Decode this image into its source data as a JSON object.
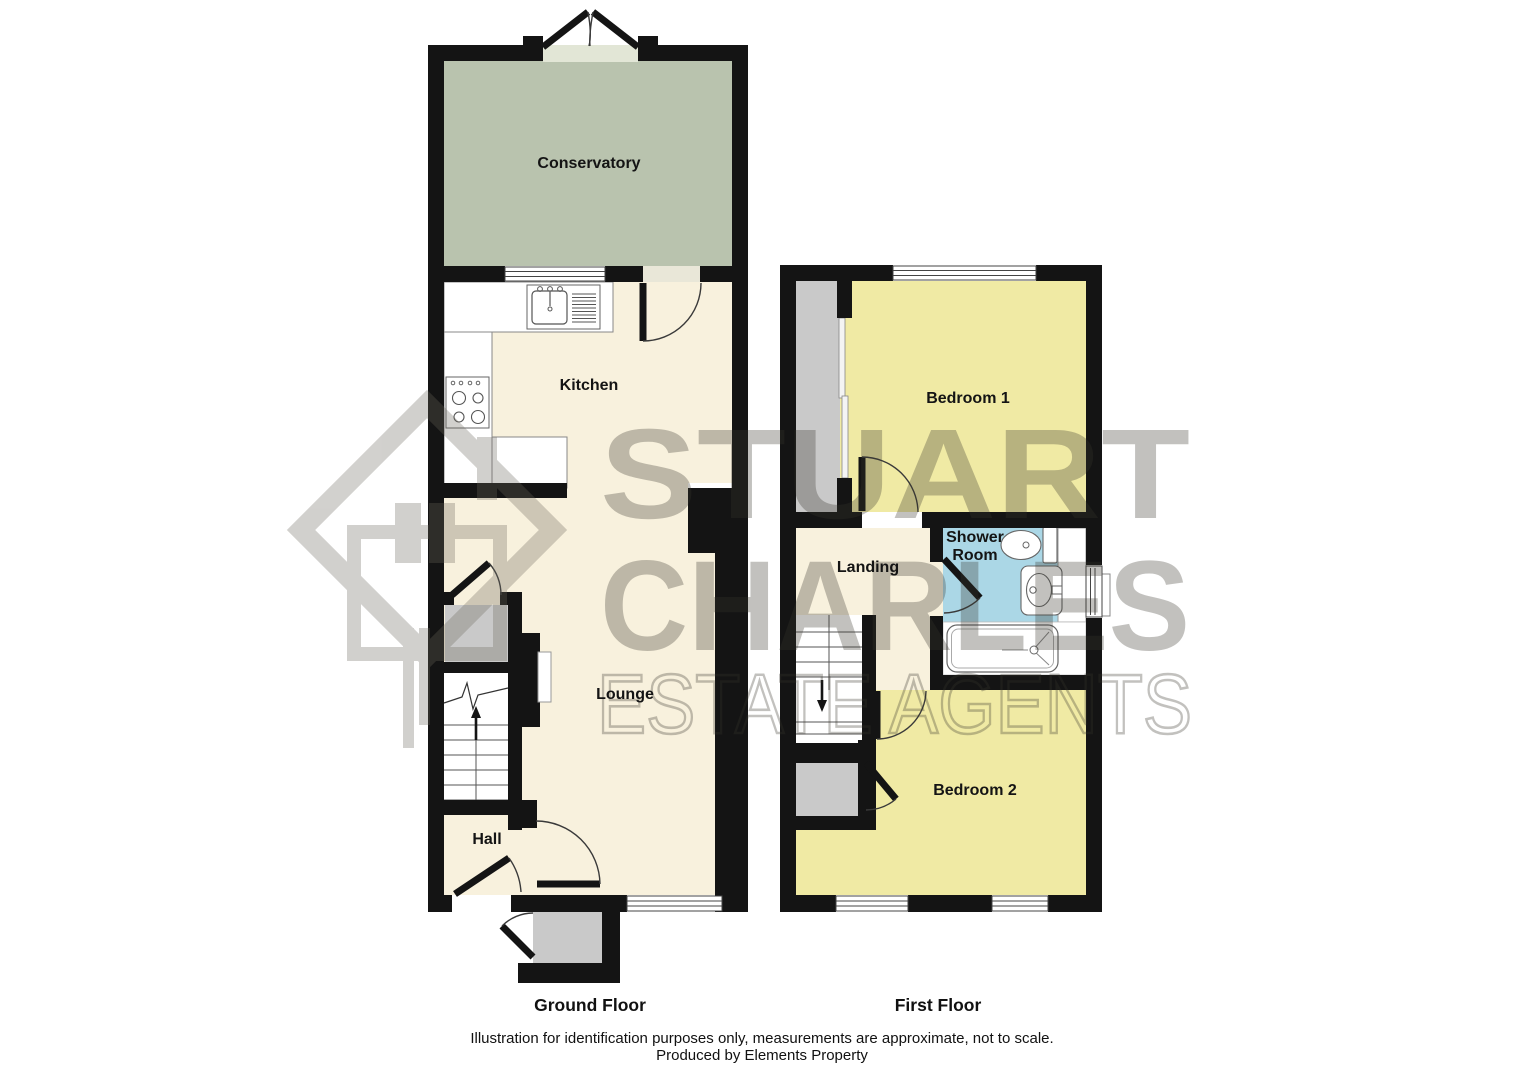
{
  "watermark": {
    "line1": "STUART",
    "line2": "CHARLES",
    "line3": "ESTATE AGENTS"
  },
  "colors": {
    "wall": "#141414",
    "cream": "#f8f1dd",
    "conservatory": "#b9c3ae",
    "conservatory_light": "#e2e6d6",
    "bedroom": "#f0eaa4",
    "shower": "#abd7e6",
    "storage_gray": "#c9c9c9",
    "watermark_text": "#38352c",
    "watermark_logo": "#6b675c"
  },
  "ground_floor": {
    "title": "Ground Floor",
    "rooms": {
      "conservatory": "Conservatory",
      "kitchen": "Kitchen",
      "lounge": "Lounge",
      "hall": "Hall"
    }
  },
  "first_floor": {
    "title": "First Floor",
    "rooms": {
      "bedroom1": "Bedroom 1",
      "shower_line1": "Shower",
      "shower_line2": "Room",
      "landing": "Landing",
      "bedroom2": "Bedroom 2"
    }
  },
  "footer": {
    "disclaimer": "Illustration for identification purposes only, measurements are approximate, not to scale.",
    "credit": "Produced by Elements Property"
  }
}
